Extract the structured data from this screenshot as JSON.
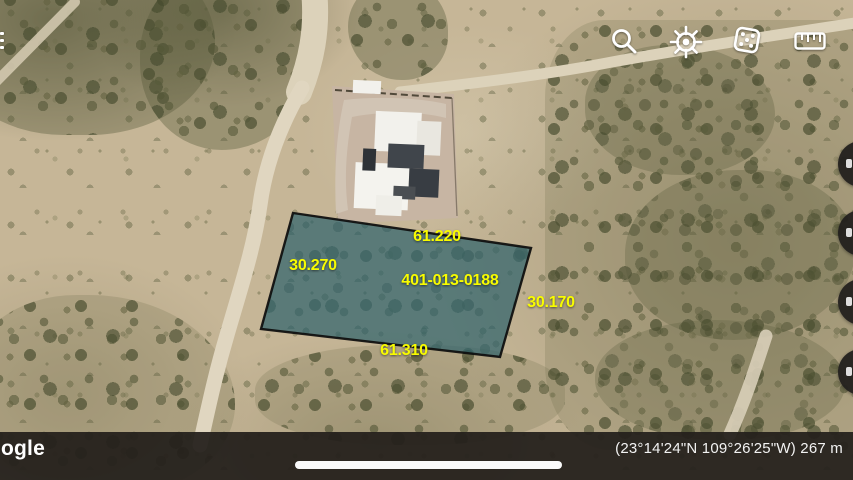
{
  "toolbar": {
    "icons": [
      {
        "name": "search"
      },
      {
        "name": "voyager-wheel"
      },
      {
        "name": "dice-feeling-lucky"
      },
      {
        "name": "measure-ruler"
      }
    ]
  },
  "nav": {
    "menu_fragment": "hamburger-menu-partially-offscreen",
    "right_fabs": [
      {
        "name": "fab-partial-1"
      },
      {
        "name": "fab-partial-2"
      },
      {
        "name": "fab-partial-3"
      },
      {
        "name": "fab-partial-4"
      }
    ]
  },
  "parcel": {
    "id": "401-013-0188",
    "dim_top": "61.220",
    "dim_left": "30.270",
    "dim_right": "30.170",
    "dim_bottom": "61.310"
  },
  "statusbar": {
    "logo_visible": "ogle",
    "coordinates": "(23°14'24\"N 109°26'25\"W) 267 m"
  },
  "colors": {
    "parcel_fill": "#1d6076",
    "parcel_stroke": "#0d0d0d",
    "label_yellow": "#f8fc00",
    "bar_background": "#24201c",
    "fab_background": "#21201d"
  }
}
